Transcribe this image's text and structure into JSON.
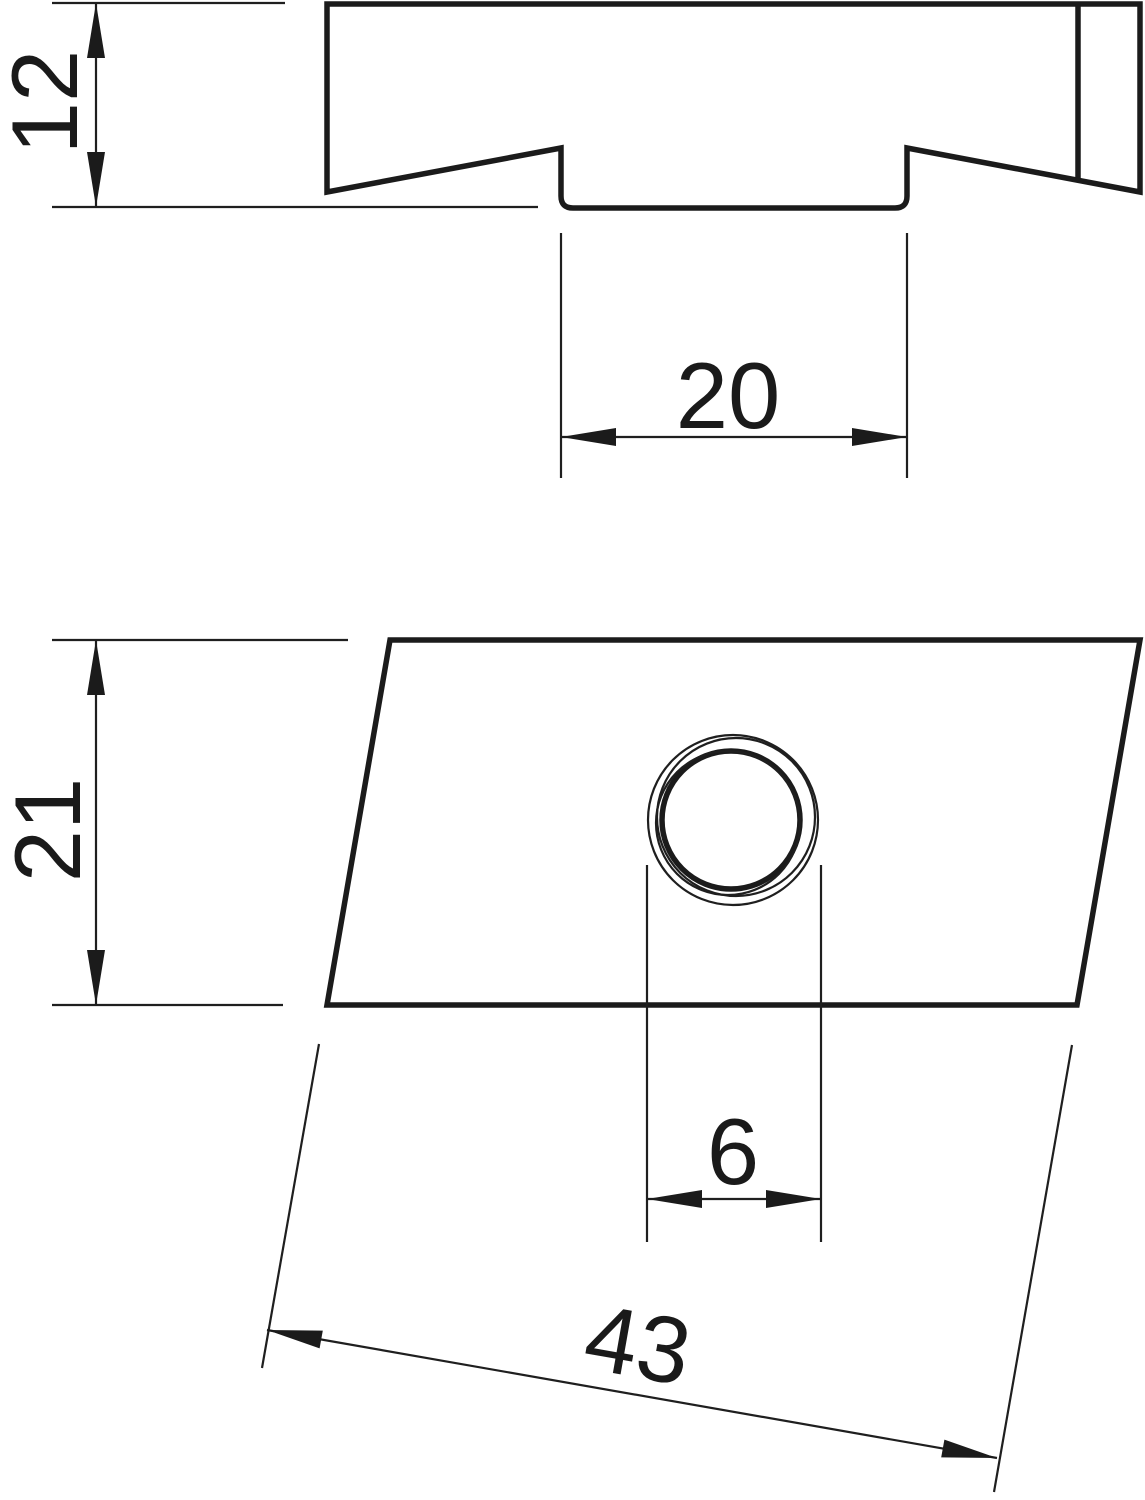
{
  "drawing": {
    "background": "#ffffff",
    "line_color": "#1b1b1b",
    "views": [
      {
        "id": "side-profile-view"
      },
      {
        "id": "plan-view"
      }
    ]
  },
  "dimensions": [
    {
      "id": "height",
      "label": "12"
    },
    {
      "id": "groove-width",
      "label": "20"
    },
    {
      "id": "plate-width",
      "label": "21"
    },
    {
      "id": "thread-diameter",
      "label": "6"
    },
    {
      "id": "plate-length",
      "label": "43"
    }
  ]
}
